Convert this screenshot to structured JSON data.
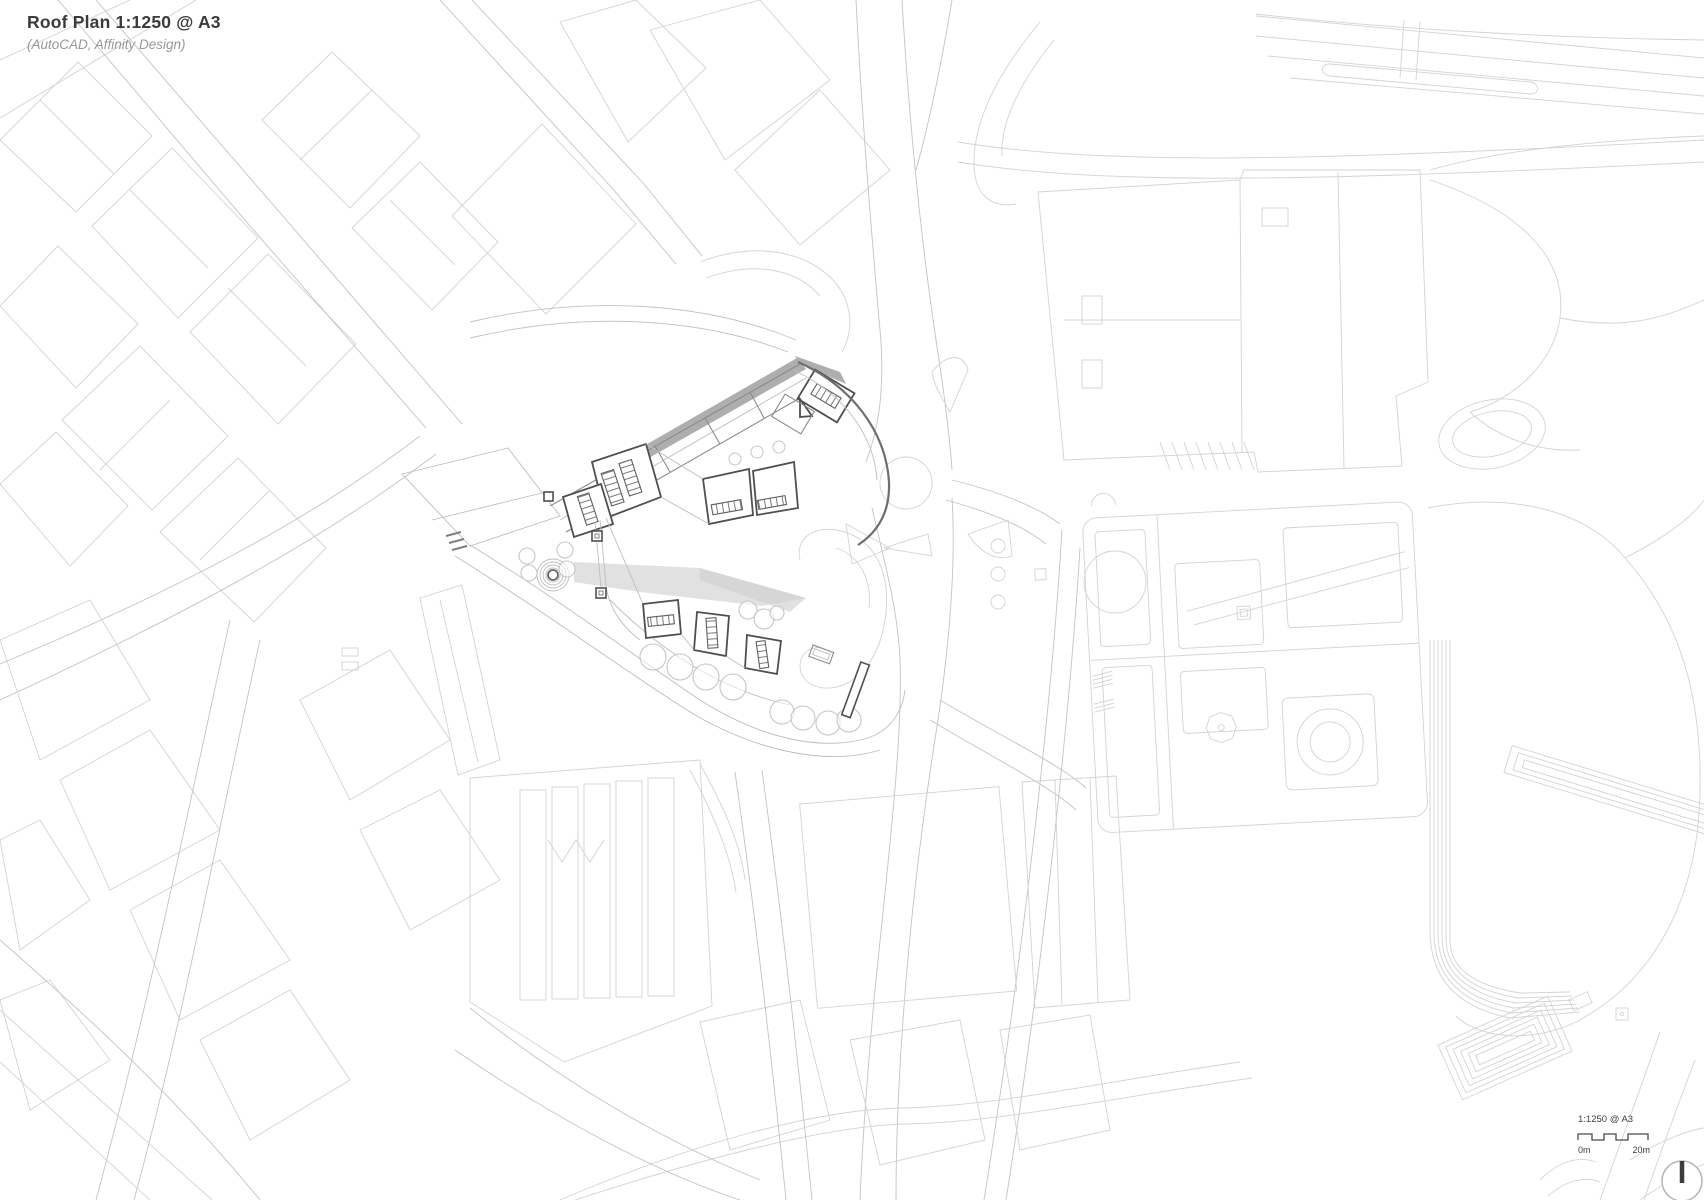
{
  "title_block": {
    "title": "Roof Plan 1:1250 @ A3",
    "subtitle": "(AutoCAD, Affinity Design)"
  },
  "scale_bar": {
    "scale_label": "1:1250 @ A3",
    "zero_label": "0m",
    "max_label": "20m"
  },
  "colors": {
    "background": "#ffffff",
    "context_line": "#d3d3d3",
    "road_line": "#c3c3c3",
    "site_line": "#4f4f4f",
    "site_mid": "#8b8b8b",
    "shadow": "#aeaeae",
    "soft_shadow": "#cfcfcf",
    "tree_line": "#c6c6c6",
    "title_text": "#3b3b3b",
    "subtitle_text": "#979797",
    "scale_text": "#3f3f3f",
    "north_circle": "#b7b7b7",
    "north_needle": "#3c3c3c"
  }
}
